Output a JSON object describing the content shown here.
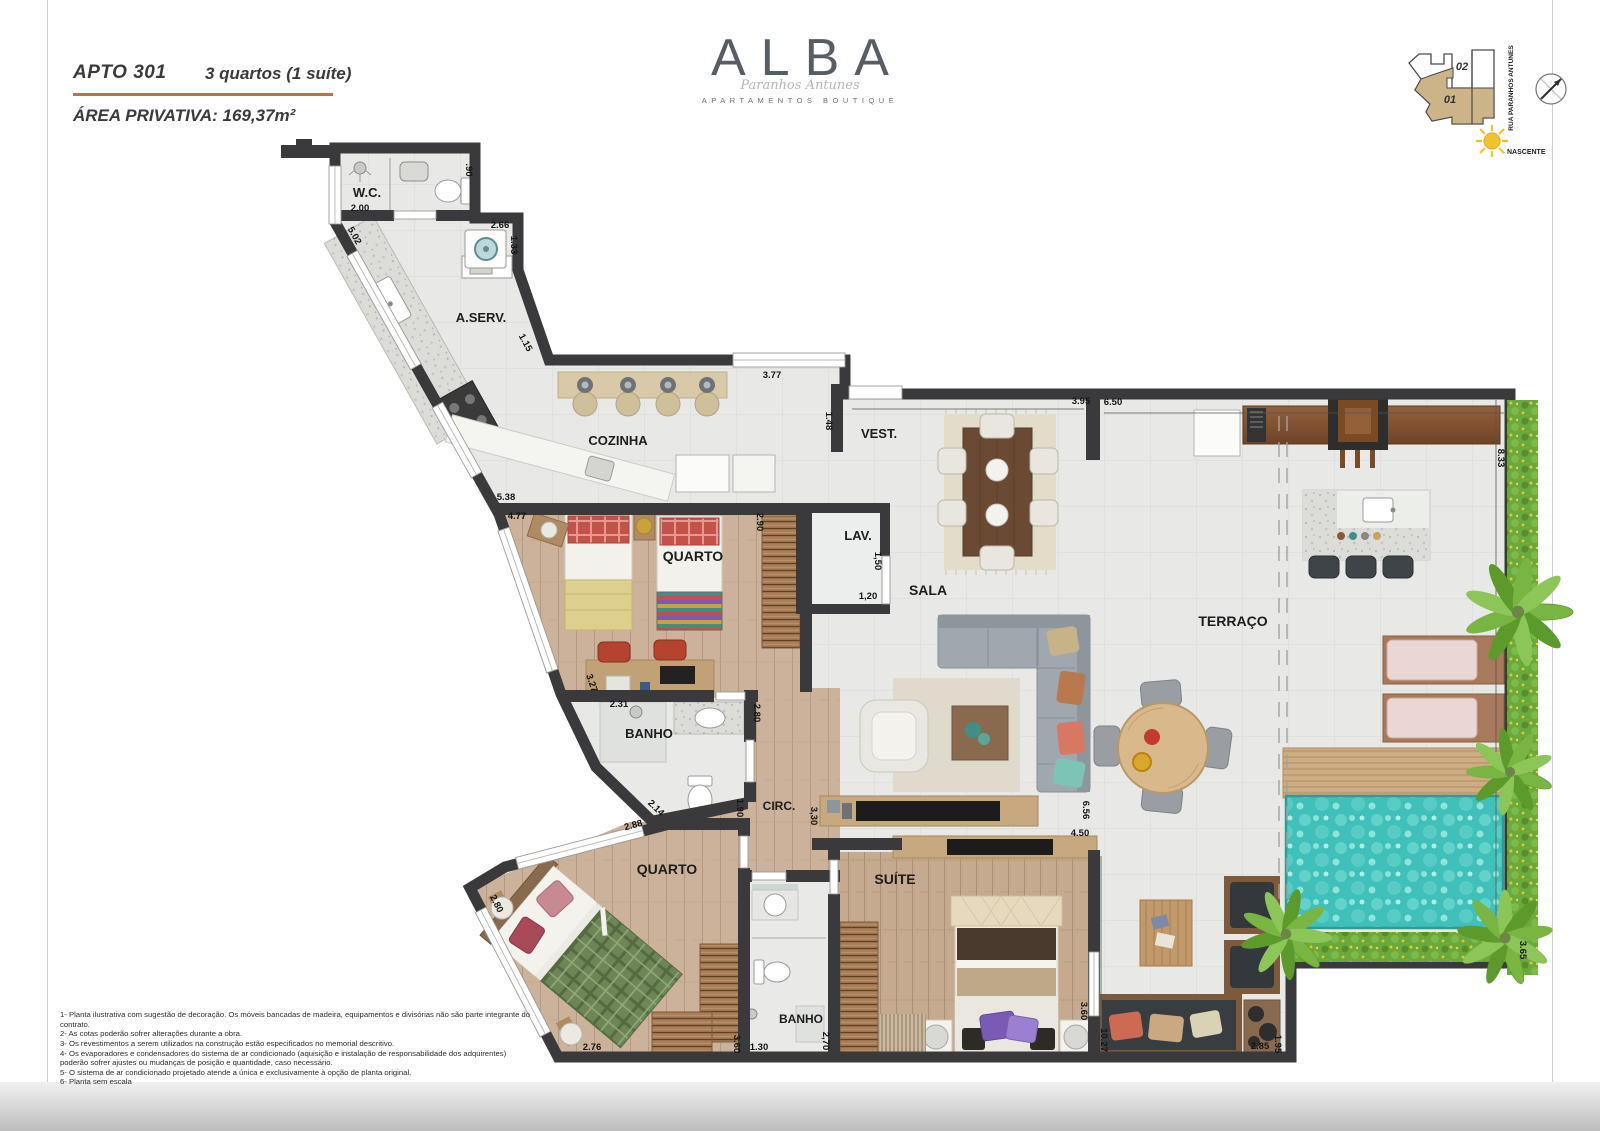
{
  "header": {
    "apto": "APTO 301",
    "tipologia": "3 quartos (1 suíte)",
    "area": "ÁREA PRIVATIVA: 169,37m²"
  },
  "logo": {
    "name": "ALBA",
    "script": "Paranhos Antunes",
    "subtitle": "APARTAMENTOS BOUTIQUE"
  },
  "sitemap": {
    "unit_top": "02",
    "unit_bottom": "01",
    "street": "RUA PARANHOS ANTUNES",
    "sun_label": "NASCENTE"
  },
  "colors": {
    "accent_rule": "#b5724c",
    "wall": "#3a3a3c",
    "pool": "#3fc0ba",
    "unit_highlight": "#cdb388"
  },
  "plan": {
    "rooms": [
      {
        "id": "wc",
        "label": "W.C.",
        "x": 367,
        "y": 197,
        "size": 13
      },
      {
        "id": "aserv",
        "label": "A.SERV.",
        "x": 481,
        "y": 322,
        "size": 13
      },
      {
        "id": "cozinha",
        "label": "COZINHA",
        "x": 618,
        "y": 445,
        "size": 13
      },
      {
        "id": "vest",
        "label": "VEST.",
        "x": 879,
        "y": 438,
        "size": 13
      },
      {
        "id": "lav",
        "label": "LAV.",
        "x": 858,
        "y": 540,
        "size": 13
      },
      {
        "id": "sala",
        "label": "SALA",
        "x": 928,
        "y": 595,
        "size": 14
      },
      {
        "id": "terraco",
        "label": "TERRAÇO",
        "x": 1233,
        "y": 626,
        "size": 14
      },
      {
        "id": "quarto1",
        "label": "QUARTO",
        "x": 693,
        "y": 561,
        "size": 14
      },
      {
        "id": "banho1",
        "label": "BANHO",
        "x": 649,
        "y": 738,
        "size": 13
      },
      {
        "id": "circ",
        "label": "CIRC.",
        "x": 779,
        "y": 810,
        "size": 12
      },
      {
        "id": "quarto2",
        "label": "QUARTO",
        "x": 667,
        "y": 874,
        "size": 14
      },
      {
        "id": "suite",
        "label": "SUÍTE",
        "x": 895,
        "y": 884,
        "size": 14
      },
      {
        "id": "banho2",
        "label": "BANHO",
        "x": 801,
        "y": 1023,
        "size": 12
      }
    ],
    "dims": [
      {
        "t": "2.00",
        "x": 360,
        "y": 211,
        "r": 0
      },
      {
        "t": ".90",
        "x": 466,
        "y": 170,
        "r": 90
      },
      {
        "t": "2.66",
        "x": 500,
        "y": 228,
        "r": 0
      },
      {
        "t": "1.33",
        "x": 511,
        "y": 245,
        "r": 90
      },
      {
        "t": "5.02",
        "x": 352,
        "y": 237,
        "r": 61
      },
      {
        "t": "1.15",
        "x": 523,
        "y": 344,
        "r": 61
      },
      {
        "t": "3.77",
        "x": 772,
        "y": 378,
        "r": 0
      },
      {
        "t": "1.48",
        "x": 826,
        "y": 421,
        "r": 90
      },
      {
        "t": "3.95",
        "x": 1081,
        "y": 404,
        "r": 0
      },
      {
        "t": "6.50",
        "x": 1113,
        "y": 405,
        "r": 0
      },
      {
        "t": "8.33",
        "x": 1498,
        "y": 458,
        "r": 90
      },
      {
        "t": "5.38",
        "x": 506,
        "y": 500,
        "r": 0
      },
      {
        "t": "4.77",
        "x": 517,
        "y": 519,
        "r": 0
      },
      {
        "t": "2.90",
        "x": 757,
        "y": 522,
        "r": 90
      },
      {
        "t": "1,50",
        "x": 875,
        "y": 561,
        "r": 90
      },
      {
        "t": "1,20",
        "x": 868,
        "y": 599,
        "r": 0
      },
      {
        "t": "3.27",
        "x": 589,
        "y": 684,
        "r": 71
      },
      {
        "t": "2.31",
        "x": 619,
        "y": 707,
        "r": 0
      },
      {
        "t": "2.80",
        "x": 754,
        "y": 713,
        "r": 90
      },
      {
        "t": "1.90",
        "x": 737,
        "y": 808,
        "r": 90
      },
      {
        "t": "2.14",
        "x": 654,
        "y": 810,
        "r": 44
      },
      {
        "t": "2.88",
        "x": 634,
        "y": 828,
        "r": -15
      },
      {
        "t": "2.80",
        "x": 494,
        "y": 905,
        "r": 63
      },
      {
        "t": "3,30",
        "x": 811,
        "y": 816,
        "r": 90
      },
      {
        "t": "6.56",
        "x": 1083,
        "y": 810,
        "r": 90
      },
      {
        "t": "4.50",
        "x": 1080,
        "y": 836,
        "r": 0
      },
      {
        "t": "2.76",
        "x": 592,
        "y": 1050,
        "r": 0
      },
      {
        "t": "3.60",
        "x": 734,
        "y": 1044,
        "r": 90
      },
      {
        "t": "1.30",
        "x": 759,
        "y": 1050,
        "r": 0
      },
      {
        "t": "2,70",
        "x": 823,
        "y": 1041,
        "r": 90
      },
      {
        "t": "3.60",
        "x": 1081,
        "y": 1011,
        "r": 90
      },
      {
        "t": "10.27",
        "x": 1101,
        "y": 1040,
        "r": 90
      },
      {
        "t": "2.85",
        "x": 1260,
        "y": 1049,
        "r": 0
      },
      {
        "t": "1.95",
        "x": 1275,
        "y": 1044,
        "r": 90
      },
      {
        "t": "3.65",
        "x": 1520,
        "y": 950,
        "r": 90
      }
    ]
  },
  "notes": [
    "1-  Planta ilustrativa com sugestão de decoração. Os móveis bancadas de madeira, equipamentos e divisórias não são parte integrante do contrato.",
    "2-  As cotas  poderão sofrer alterações durante a obra.",
    "3-  Os revestimentos a serem utilizados na construção  estão especificados no memorial descritivo.",
    "4-  Os evaporadores e condensadores do sistema de ar condicionado (aquisição e instalação de responsabilidade dos adquirentes) poderão sofrer ajustes ou mudanças de posição e quantidade, caso necessário.",
    "5-  O sistema de ar condicionado projetado atende a única e exclusivamente à opção de planta original.",
    "6-  Planta sem escala"
  ]
}
